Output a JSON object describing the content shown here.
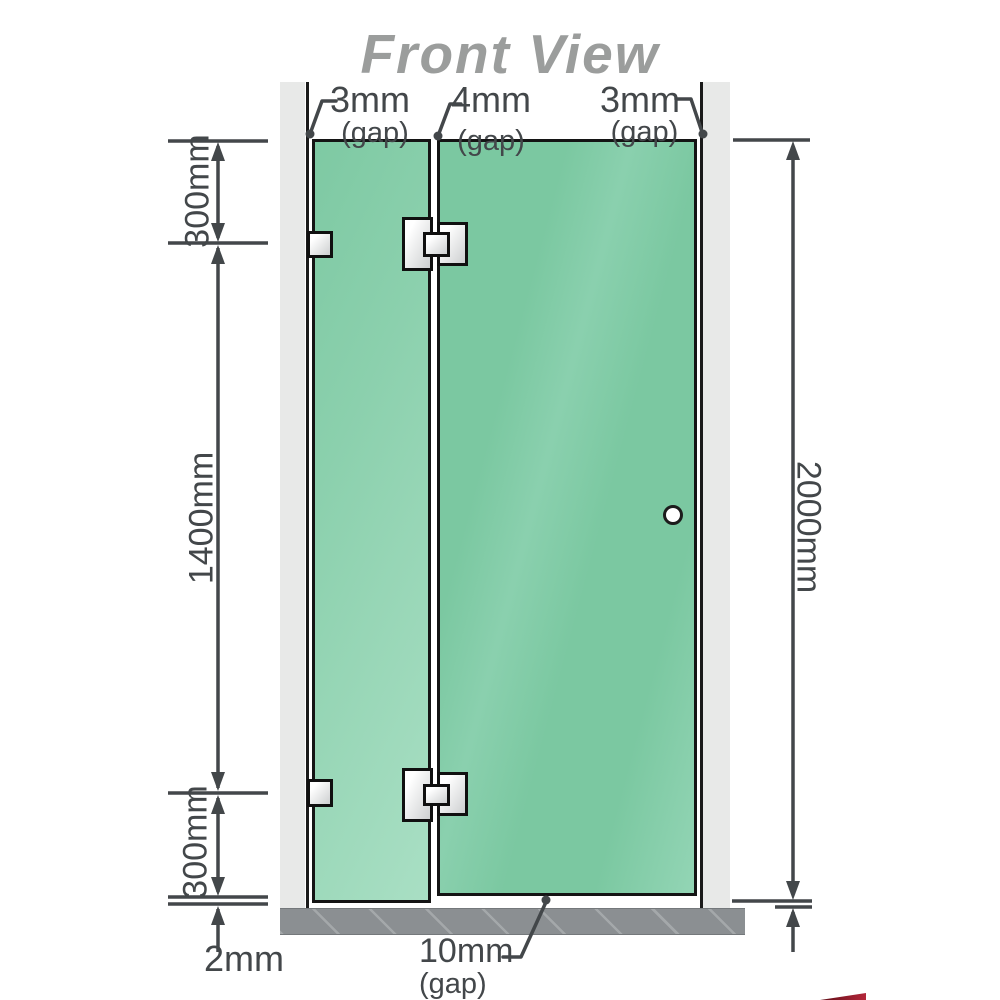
{
  "title": "Front View",
  "dimensions": {
    "left_top": "300mm",
    "left_middle": "1400mm",
    "left_bottom": "300mm",
    "right_total": "2000mm",
    "floor_gap": "2mm"
  },
  "gaps": {
    "left": {
      "value": "3mm",
      "label": "(gap)"
    },
    "middle": {
      "value": "4mm",
      "label": "(gap)"
    },
    "right": {
      "value": "3mm",
      "label": "(gap)"
    },
    "bottom": {
      "value": "10mm",
      "label": "(gap)"
    }
  },
  "colors": {
    "glass_green": "#7cc9a2",
    "glass_light": "#a9dfc4",
    "wall_gray": "#e8e9e8",
    "floor_gray": "#8b8f92",
    "line_dark": "#43474a",
    "title_gray": "#9b9d9c",
    "logo_red": "#b5273a"
  }
}
